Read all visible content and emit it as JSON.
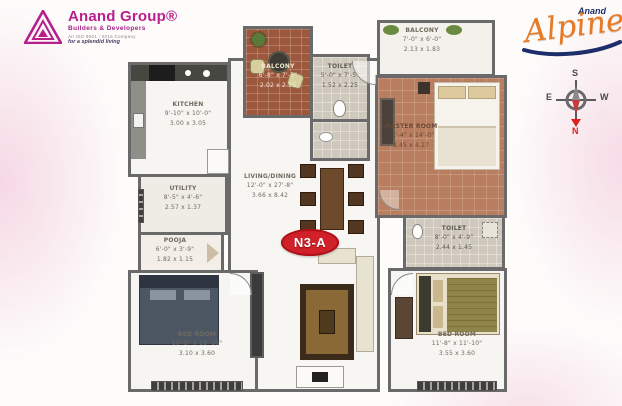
{
  "brand": {
    "name": "Anand Group®",
    "division": "Builders & Developers",
    "iso": "An ISO 9001 : 2015 Company",
    "motto": "for a splendid living"
  },
  "project": {
    "prefix": "Anand",
    "name": "Alpine"
  },
  "badge": "N3-A",
  "compass": {
    "n": "N",
    "s": "S",
    "e": "E",
    "w": "W"
  },
  "rooms": {
    "kitchen": {
      "label": "KITCHEN",
      "ft": "9'-10\" x 10'-0\"",
      "m": "3.00 x 3.05"
    },
    "utility": {
      "label": "UTILITY",
      "ft": "8'-5\" x 4'-6\"",
      "m": "2.57 x 1.37"
    },
    "pooja": {
      "label": "POOJA",
      "ft": "6'-0\" x 3'-9\"",
      "m": "1.82 x 1.15"
    },
    "living": {
      "label": "LIVING/DINING",
      "ft": "12'-0\" x 27'-8\"",
      "m": "3.66 x 8.42"
    },
    "balcony_left": {
      "label": "BALCONY",
      "ft": "6'-8\" x 7'-5\"",
      "m": "2.02 x 2.25"
    },
    "toilet_top": {
      "label": "TOILET",
      "ft": "5'-0\" x 7'-5\"",
      "m": "1.52 x 2.25"
    },
    "balcony_right": {
      "label": "BALCONY",
      "ft": "7'-0\" x 6'-0\"",
      "m": "2.13 x 1.83"
    },
    "master": {
      "label": "MASTER ROOM",
      "ft": "11'-4\" x 14'-0\"",
      "m": "3.45 x 4.27"
    },
    "toilet_right": {
      "label": "TOILET",
      "ft": "8'-0\" x 4'-9\"",
      "m": "2.44 x 1.45"
    },
    "bed_left": {
      "label": "BED ROOM",
      "ft": "10'-2\" x 11'-10\"",
      "m": "3.10 x 3.60"
    },
    "bed_right": {
      "label": "BED ROOM",
      "ft": "11'-8\" x 11'-10\"",
      "m": "3.55 x 3.60"
    }
  },
  "colors": {
    "brand_magenta": "#b81f8c",
    "project_orange": "#e87a26",
    "project_navy": "#1d2e6b",
    "badge_red": "#d0202a",
    "wall_gray": "#6a6a6a",
    "balcony_brick": "#9c573d",
    "master_terracotta": "#b97e60"
  }
}
